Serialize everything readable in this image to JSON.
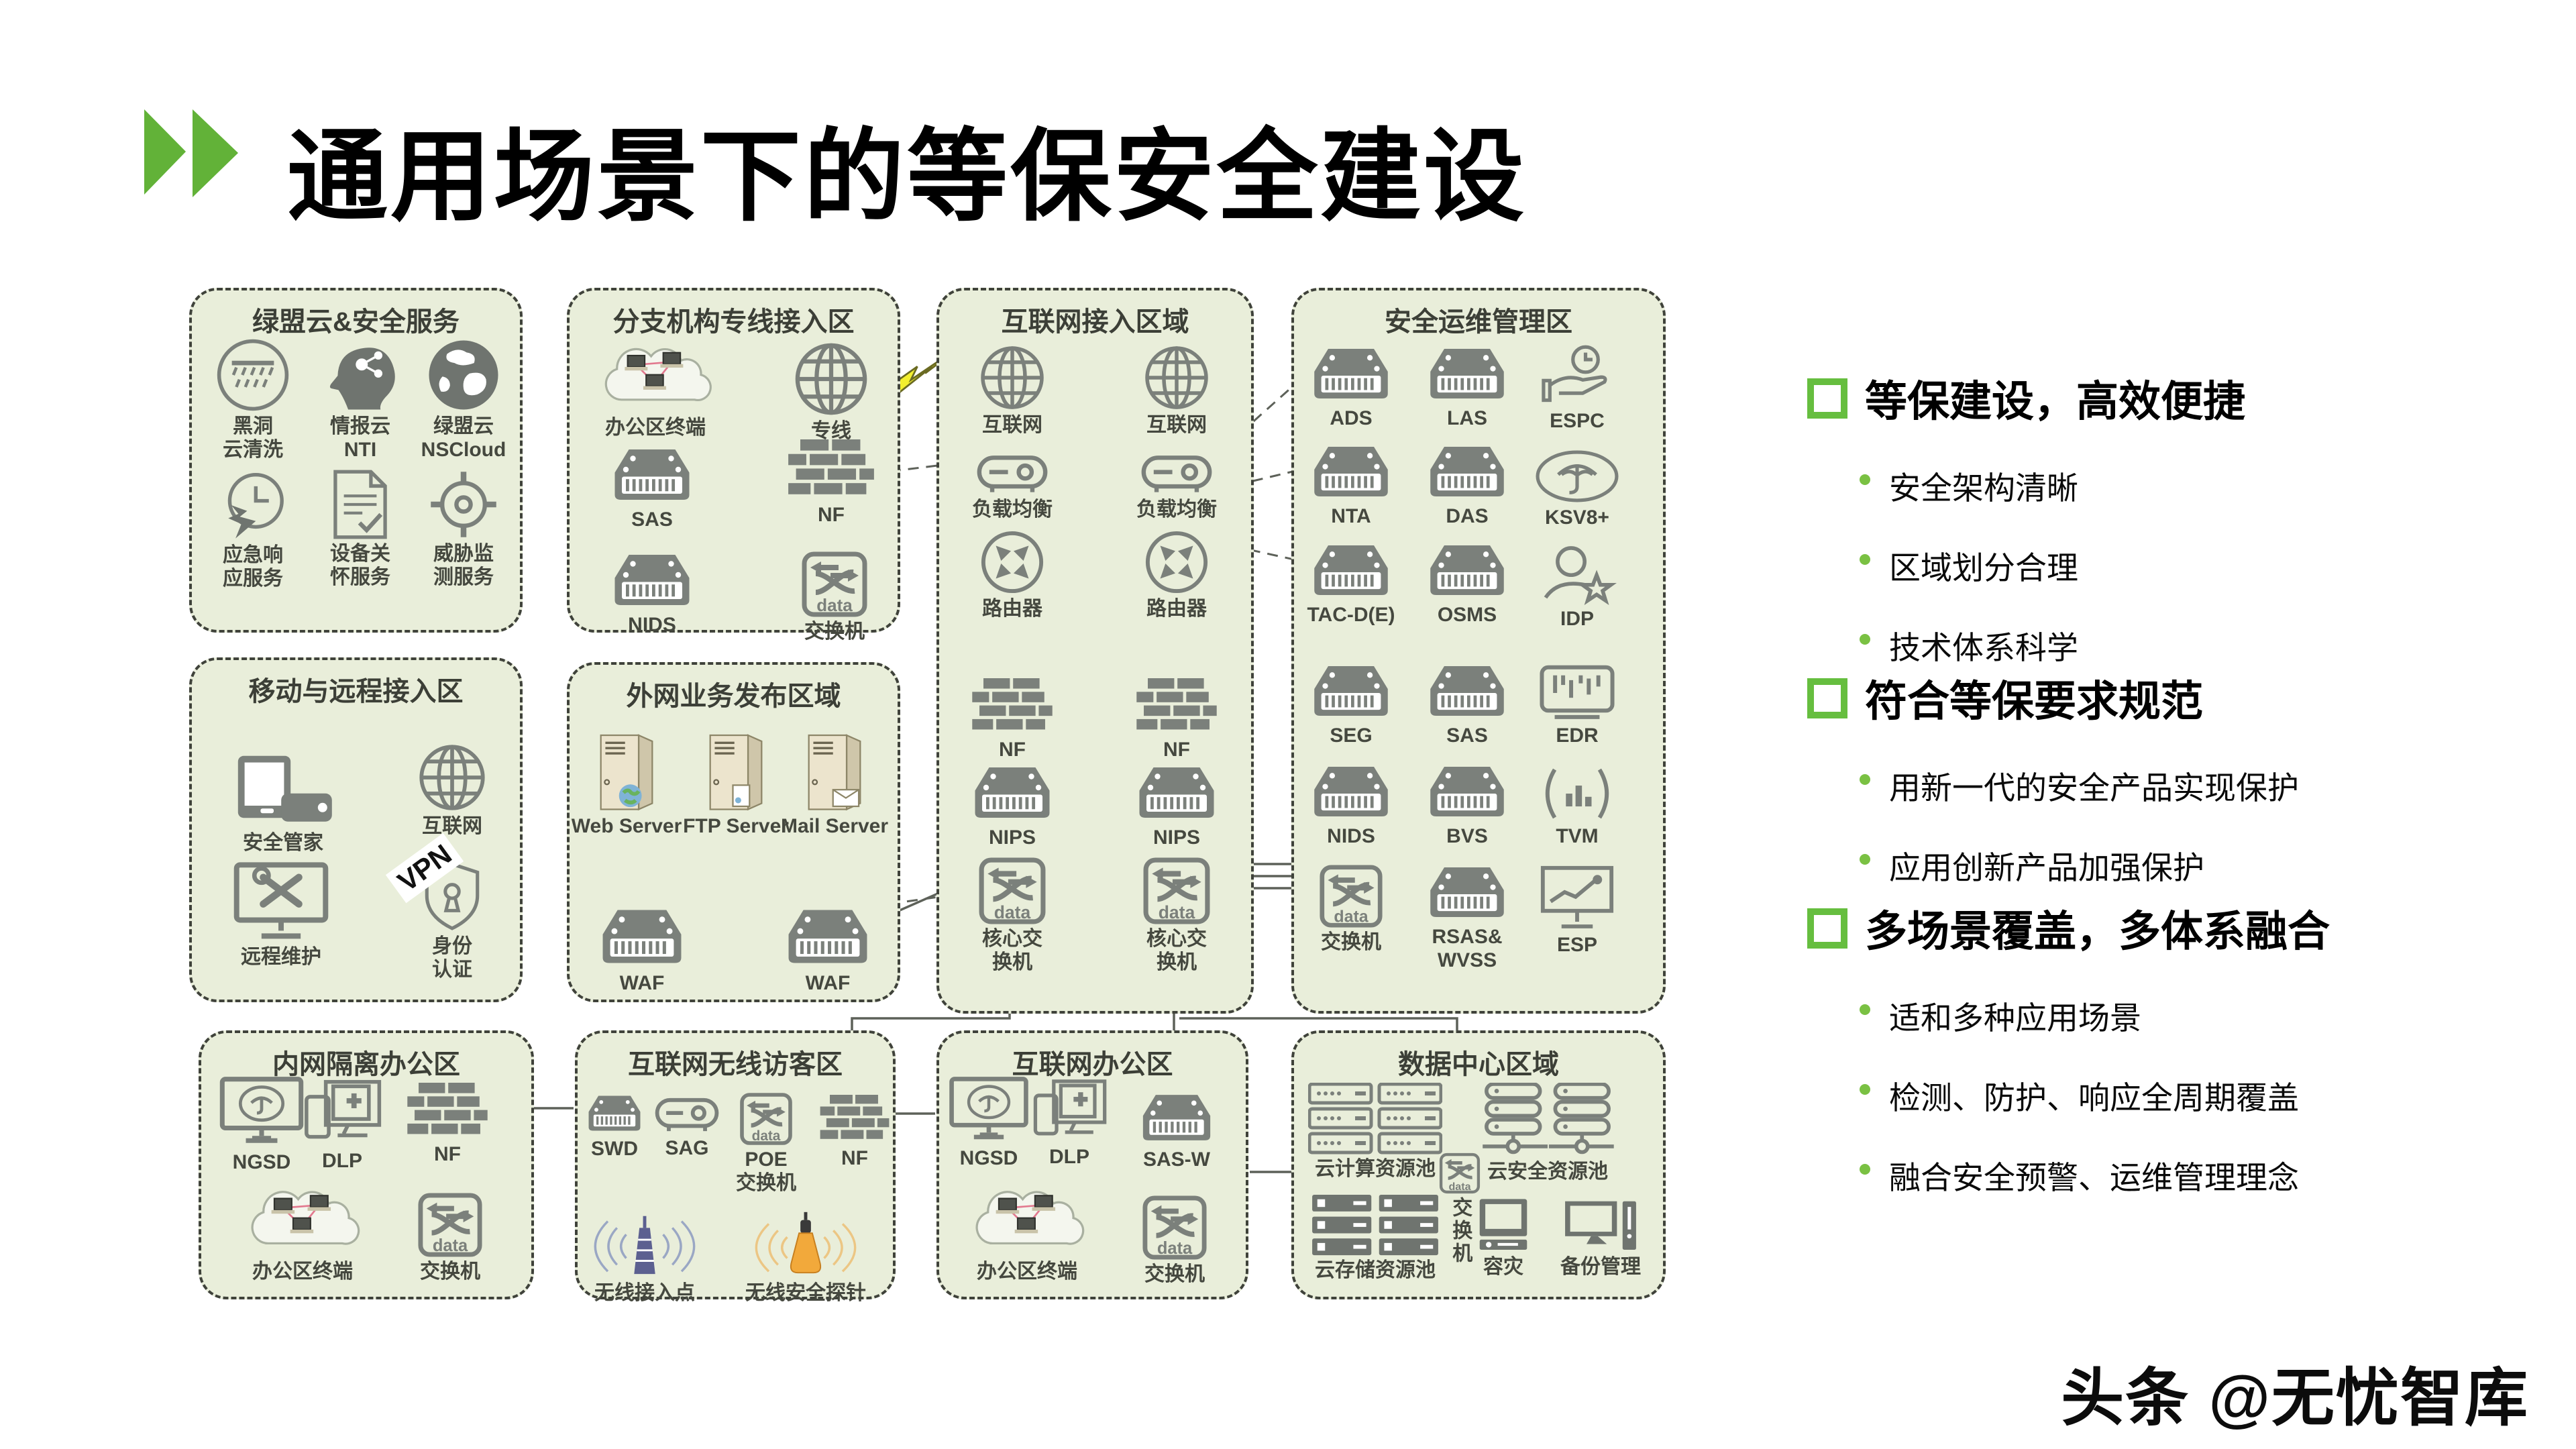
{
  "slide": {
    "title": "通用场景下的等保安全建设",
    "watermark": "头条 @无忧智库"
  },
  "colors": {
    "accent_green": "#66be3f",
    "bullet_green": "#7ac143",
    "zone_bg": "#e9eeda",
    "icon_gray": "#7b807b",
    "vpn_yellow": "#f3ef2f"
  },
  "icons": {
    "switch_text": "data"
  },
  "connectors": {
    "vpn_label": "VPN"
  },
  "zones": [
    {
      "title": "绿盟云&安全服务",
      "items": [
        {
          "label": "黑洞\n云清洗"
        },
        {
          "label": "情报云\nNTI"
        },
        {
          "label": "绿盟云\nNSCloud"
        },
        {
          "label": "应急响\n应服务"
        },
        {
          "label": "设备关\n怀服务"
        },
        {
          "label": "威胁监\n测服务"
        }
      ]
    },
    {
      "title": "分支机构专线接入区",
      "items": [
        {
          "label": "办公区终端"
        },
        {
          "label": "专线"
        },
        {
          "label": "SAS"
        },
        {
          "label": "NF"
        },
        {
          "label": "NIDS"
        },
        {
          "label": "交换机"
        }
      ]
    },
    {
      "title": "互联网接入区域",
      "items": [
        {
          "label": "互联网"
        },
        {
          "label": "互联网"
        },
        {
          "label": "负载均衡"
        },
        {
          "label": "负载均衡"
        },
        {
          "label": "路由器"
        },
        {
          "label": "路由器"
        },
        {
          "label": "NF"
        },
        {
          "label": "NF"
        },
        {
          "label": "NIPS"
        },
        {
          "label": "NIPS"
        },
        {
          "label": "核心交\n换机"
        },
        {
          "label": "核心交\n换机"
        }
      ]
    },
    {
      "title": "安全运维管理区",
      "items": [
        {
          "label": "ADS"
        },
        {
          "label": "LAS"
        },
        {
          "label": "ESPC"
        },
        {
          "label": "NTA"
        },
        {
          "label": "DAS"
        },
        {
          "label": "KSV8+"
        },
        {
          "label": "TAC-D(E)"
        },
        {
          "label": "OSMS"
        },
        {
          "label": "IDP"
        },
        {
          "label": "SEG"
        },
        {
          "label": "SAS"
        },
        {
          "label": "EDR"
        },
        {
          "label": "NIDS"
        },
        {
          "label": "BVS"
        },
        {
          "label": "TVM"
        },
        {
          "label": "交换机"
        },
        {
          "label": "RSAS&\nWVSS"
        },
        {
          "label": "ESP"
        }
      ]
    },
    {
      "title": "移动与远程接入区",
      "items": [
        {
          "label": "安全管家"
        },
        {
          "label": "互联网"
        },
        {
          "label": "远程维护"
        },
        {
          "label": "身份\n认证"
        }
      ]
    },
    {
      "title": "外网业务发布区域",
      "items": [
        {
          "label": "Web Server"
        },
        {
          "label": "FTP Server"
        },
        {
          "label": "Mail Server"
        },
        {
          "label": "WAF"
        },
        {
          "label": "WAF"
        }
      ]
    },
    {
      "title": "内网隔离办公区",
      "items": [
        {
          "label": "NGSD"
        },
        {
          "label": "DLP"
        },
        {
          "label": "NF"
        },
        {
          "label": "办公区终端"
        },
        {
          "label": "交换机"
        }
      ]
    },
    {
      "title": "互联网无线访客区",
      "items": [
        {
          "label": "SWD"
        },
        {
          "label": "SAG"
        },
        {
          "label": "POE\n交换机"
        },
        {
          "label": "NF"
        },
        {
          "label": "无线接入点"
        },
        {
          "label": "无线安全探针"
        }
      ]
    },
    {
      "title": "互联网办公区",
      "items": [
        {
          "label": "NGSD"
        },
        {
          "label": "DLP"
        },
        {
          "label": "SAS-W"
        },
        {
          "label": "办公区终端"
        },
        {
          "label": "交换机"
        }
      ]
    },
    {
      "title": "数据中心区域",
      "items": [
        {
          "label": "云计算资源池"
        },
        {
          "label": "云安全资源池"
        },
        {
          "label": "交换机"
        },
        {
          "label": "云存储资源池"
        },
        {
          "label": "容灾"
        },
        {
          "label": "备份管理"
        }
      ]
    }
  ],
  "right_panel": {
    "sections": [
      {
        "heading": "等保建设，高效便捷",
        "bullets": [
          "安全架构清晰",
          "区域划分合理",
          "技术体系科学"
        ]
      },
      {
        "heading": "符合等保要求规范",
        "bullets": [
          "用新一代的安全产品实现保护",
          "应用创新产品加强保护"
        ]
      },
      {
        "heading": "多场景覆盖，多体系融合",
        "bullets": [
          "适和多种应用场景",
          "检测、防护、响应全周期覆盖",
          "融合安全预警、运维管理理念"
        ]
      }
    ]
  }
}
